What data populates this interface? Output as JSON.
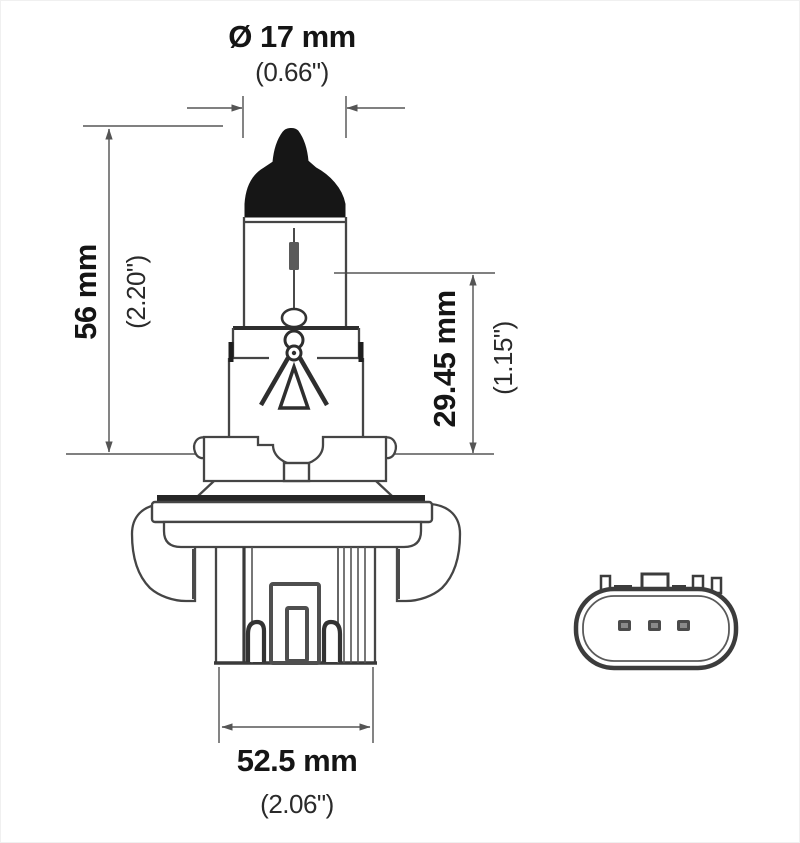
{
  "diagram": {
    "type": "bulb-dimensional-drawing",
    "views": [
      "side-view-bulb",
      "front-view-connector"
    ]
  },
  "dimensions": {
    "diameter": {
      "metric": "Ø 17 mm",
      "imperial": "(0.66\")"
    },
    "overall_height": {
      "metric": "56 mm",
      "imperial": "(2.20\")"
    },
    "filament_height": {
      "metric": "29.45 mm",
      "imperial": "(1.15\")"
    },
    "base_width": {
      "metric": "52.5 mm",
      "imperial": "(2.06\")"
    }
  },
  "connector": {
    "pin_count": 3
  },
  "colors": {
    "background": "#ffffff",
    "outline": "#454545",
    "heavy_line": "#2e2e2e",
    "dimension_line": "#6e6e6e",
    "text": "#151515",
    "cap_fill": "#161616"
  }
}
